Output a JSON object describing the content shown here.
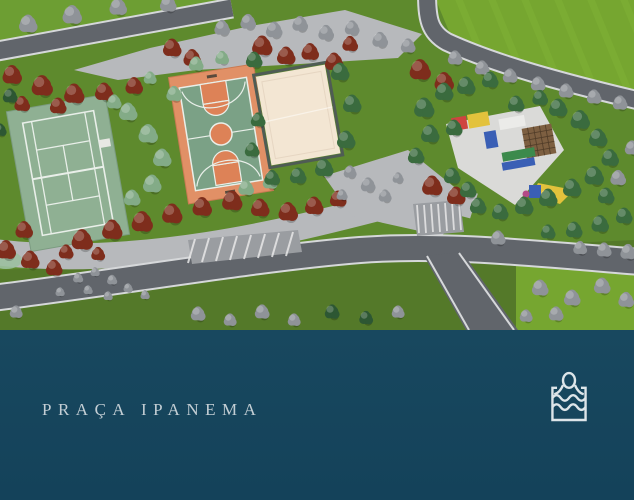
{
  "banner": {
    "title": "PRAÇA IPANEMA",
    "icon": "pool-swimmer-icon"
  },
  "scene": {
    "type": "aerial-3d-render",
    "description": "Aerial 3D rendering of a park square with tennis court, basketball court, sand volleyball court, playground, curved roads, parking bays and dense red, green and silver trees"
  },
  "colors": {
    "banner-bg": "#18485f",
    "banner-bg-deep": "#14425a",
    "banner-text": "#c3ced4",
    "icon-stroke": "#dde5e9",
    "grass-base": "#5e8a2d",
    "grass-bright": "#76a630",
    "grass-dark": "#547929",
    "grass-corner": "#6d9e33",
    "lawn-stripe": "#86b83a",
    "road": "#61656b",
    "curb": "#d6d8da",
    "walkway": "#b7b9bc",
    "plaza-white": "#dadad8",
    "parking-band": "#9a9da1",
    "tree-red": "#7e2d1c",
    "tree-green": "#3a6b3e",
    "tree-dgreen": "#2d5733",
    "tree-pale": "#83ab87",
    "tree-gray": "#8f9398",
    "tennis-slab": "#8fb093",
    "court-line": "#e9efe9",
    "bball-border": "#e19066",
    "bball-inner": "#7ba186",
    "bball-key": "#dd8257",
    "sand": "#f3e6d3",
    "fence": "#4f5c54",
    "play-red": "#cf4440",
    "play-yellow": "#e3c23c",
    "play-blue": "#3a5fb5",
    "play-green": "#3c8a4c",
    "pergola": "#7d5f41",
    "play-pink": "#b44a86"
  }
}
